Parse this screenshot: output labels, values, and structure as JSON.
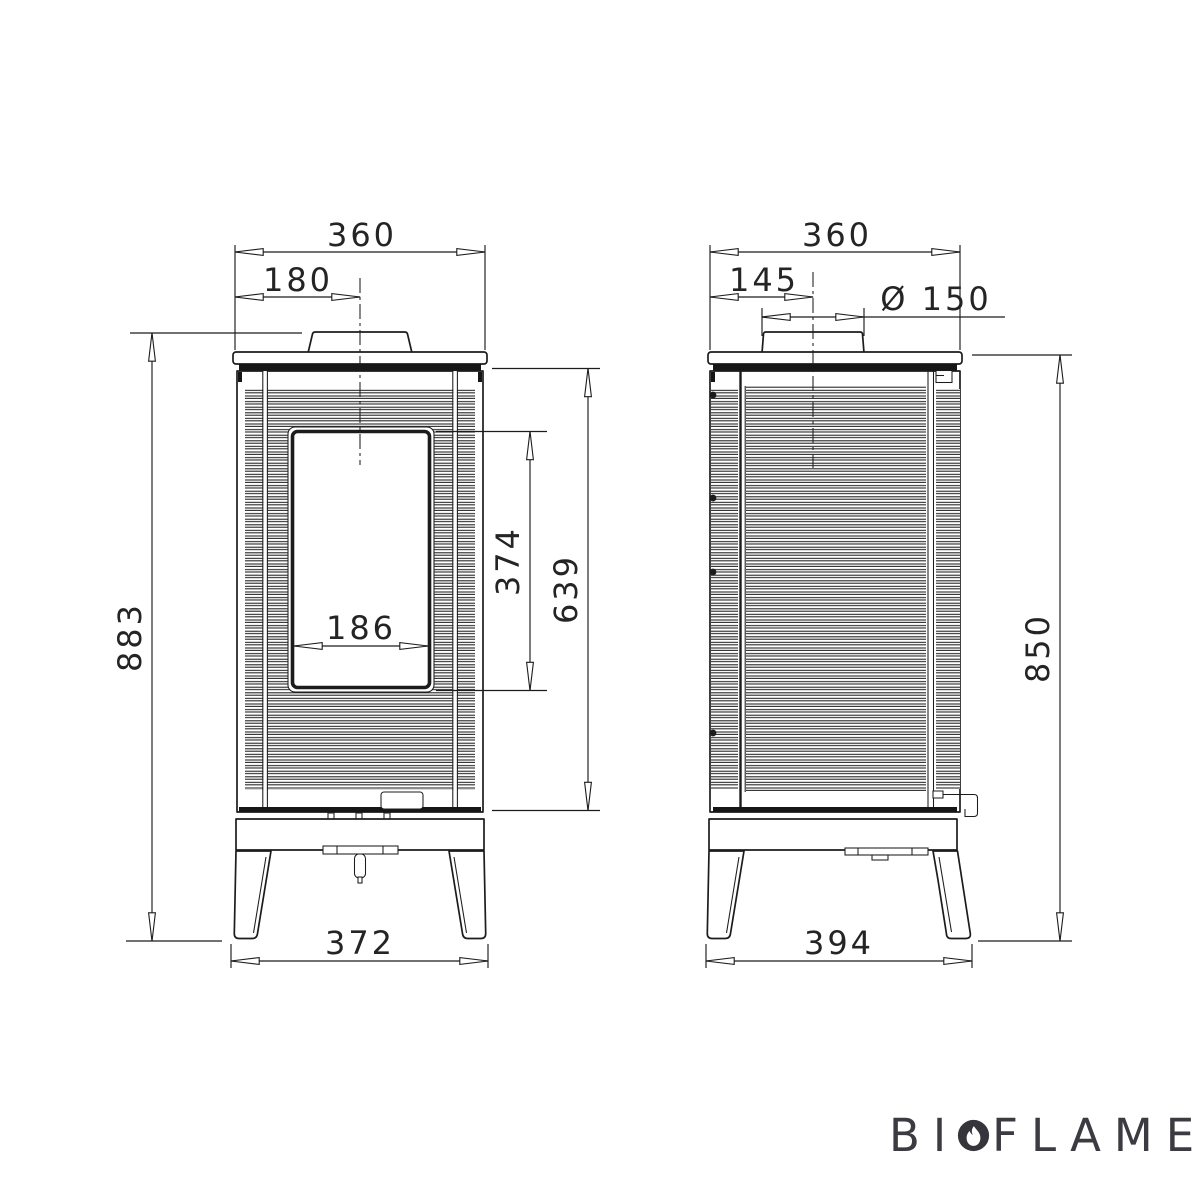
{
  "colors": {
    "line": "#1c1c1c",
    "dimension_text": "#242424",
    "background": "#ffffff",
    "logo": "#3b3b41"
  },
  "front_view": {
    "top_width": "360",
    "flue_center_offset": "180",
    "overall_height": "883",
    "glass_height": "374",
    "body_height": "639",
    "glass_width": "186",
    "base_width": "372"
  },
  "side_view": {
    "top_width": "360",
    "flue_center_offset": "145",
    "flue_diameter": "Ø 150",
    "overall_height": "850",
    "base_width": "394"
  },
  "logo": {
    "prefix": "BI",
    "suffix": "FLAME",
    "registered": "®",
    "icon": "flame-in-circle"
  }
}
